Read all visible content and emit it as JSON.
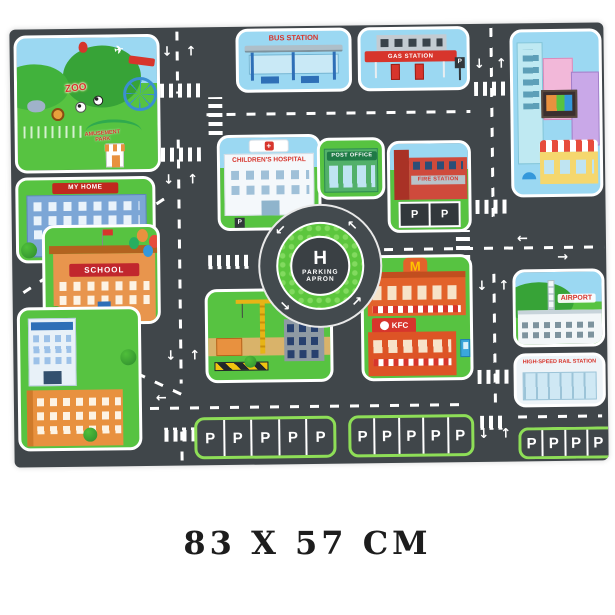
{
  "caption": "83 X 57 CM",
  "labels": {
    "zoo": "ZOO",
    "amusement_park": "AMUSEMENT PARK",
    "my_home": "MY HOME",
    "school": "SCHOOL",
    "bus_station": "BUS STATION",
    "gas_station": "GAS STATION",
    "childrens_hospital": "CHILDREN'S HOSPITAL",
    "post_office": "POST OFFICE",
    "fire_station": "FIRE STATION",
    "mcdonalds": "M",
    "kfc": "KFC",
    "airport": "AIRPORT",
    "rail_station": "HIGH-SPEED RAIL STATION"
  },
  "helipad": {
    "letter": "H",
    "word1": "PARKING",
    "word2": "APRON"
  },
  "parking": {
    "stall": "P"
  },
  "icons": {
    "arrow_up": "↑",
    "arrow_down": "↓",
    "arrow_left": "←",
    "arrow_right": "→",
    "plane": "✈",
    "cross": "+"
  },
  "colors": {
    "road": "#40464a",
    "grass": "#57c341",
    "sky": "#9bd8f2",
    "accent_red": "#d7352c",
    "parking_green": "#8ede57"
  }
}
